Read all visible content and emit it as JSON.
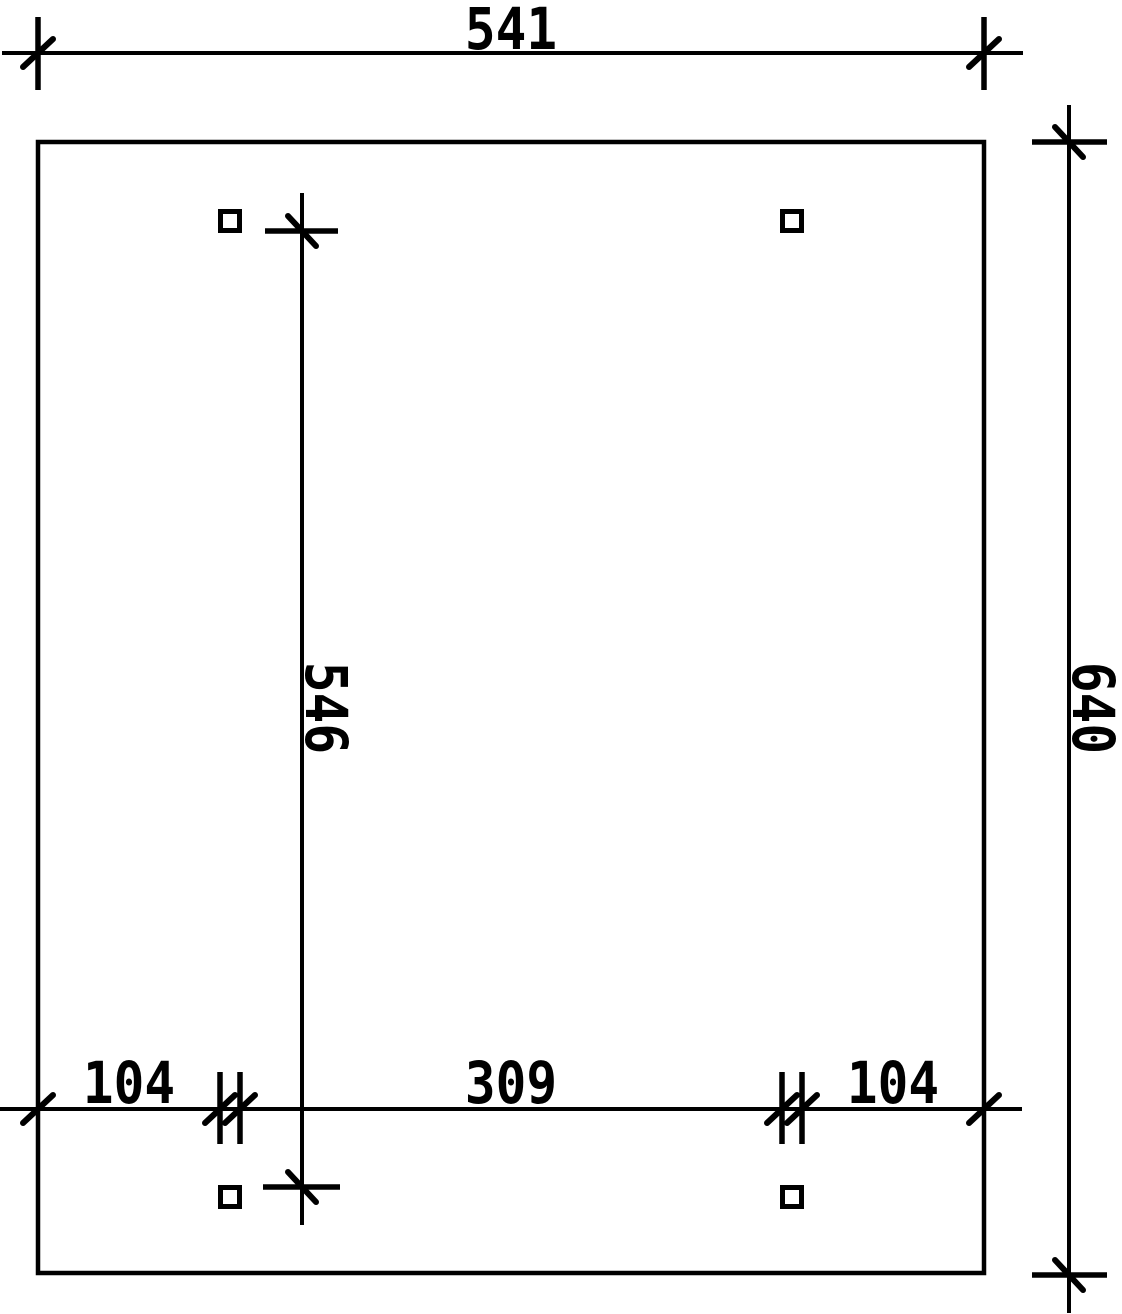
{
  "colors": {
    "ink": "#000000",
    "paper": "#ffffff"
  },
  "dimensions": {
    "top": "541",
    "right": "640",
    "middle": "546",
    "bottom_left": "104",
    "bottom_center": "309",
    "bottom_right": "104"
  }
}
